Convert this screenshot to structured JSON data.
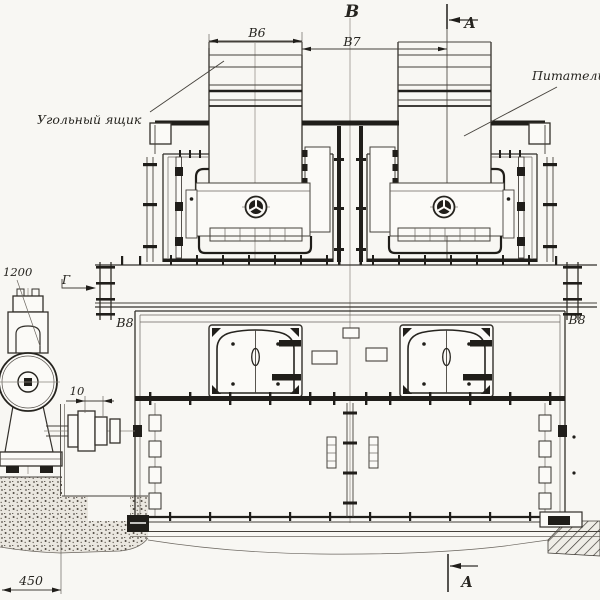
{
  "labels": {
    "view_b": "В",
    "section_a_top": "А",
    "section_a_bottom": "А",
    "view_g": "Г",
    "dim_b6": "В6",
    "dim_b7": "В7",
    "dim_b8_left": "В8",
    "dim_b8_right": "В8",
    "dim_1200": "1200",
    "dim_10": "10",
    "dim_450": "450",
    "callout_coal_box": "Угольный ящик",
    "callout_feeder": "Питатель"
  },
  "colors": {
    "paper": "#f8f7f3",
    "ink": "#26241f",
    "thin_line": "#45413b",
    "thick_line": "#201e1a"
  }
}
